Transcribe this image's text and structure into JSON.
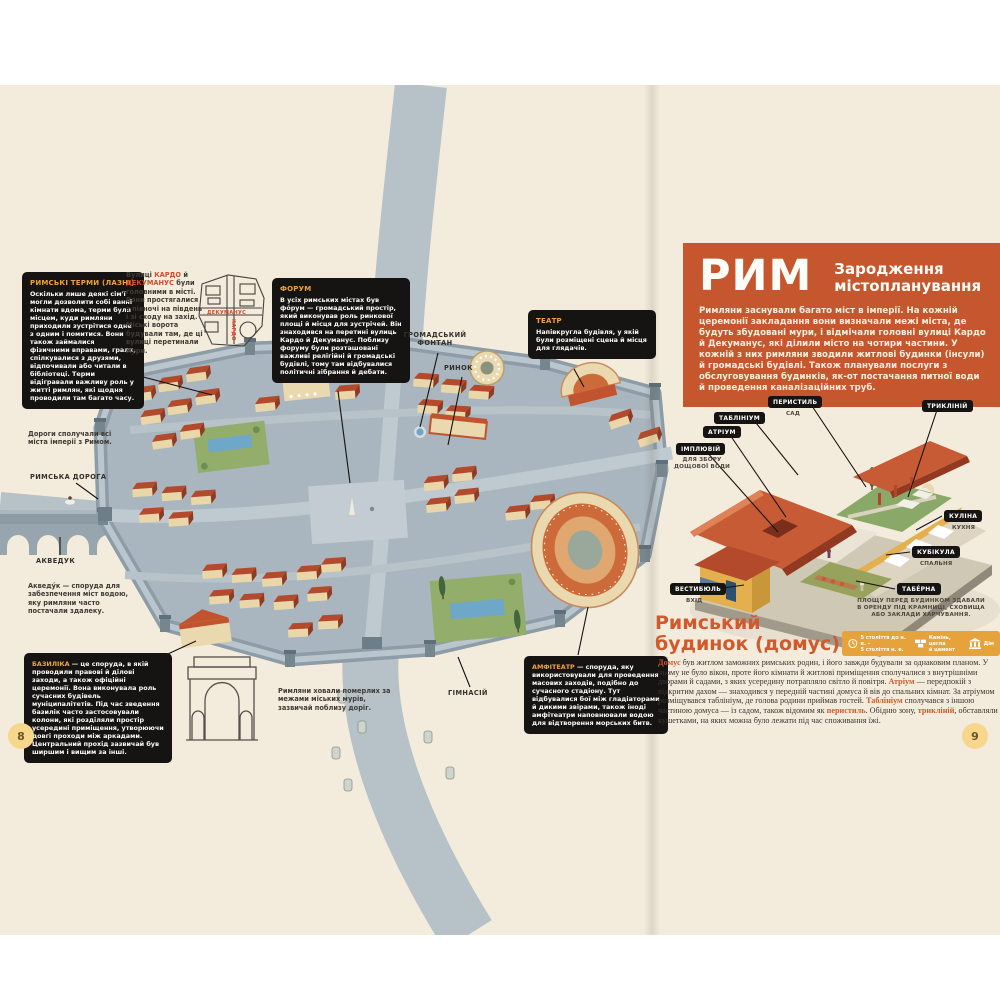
{
  "colors": {
    "accent_orange": "#c5562d",
    "highlight_red": "#d44b28",
    "box_heading_gold": "#f0a23a",
    "legend_bar": "#e7a33b",
    "paper": "#f3ecdd"
  },
  "left_page": {
    "page_number": "8",
    "thermae_box": {
      "title": "РИМСЬКІ ТЕРМИ (ЛАЗНІ)",
      "body": "Оскільки лише деякі сім'ї могли дозволити собі ванні кімнати вдома, терми були місцем, куди римляни приходили зустрітися одне з одним і помитися. Вони також займалися фізичними вправами, грали, спілкувалися з друзями, відпочивали або читали в бібліотеці. Терми відігравали важливу роль у житті римлян, які щодня проводили там багато часу."
    },
    "cardo_note_segments": [
      {
        "t": "Вулиці "
      },
      {
        "t": "КАРДО",
        "c": "c-red"
      },
      {
        "t": " й "
      },
      {
        "t": "ДЕКУМАНУС",
        "c": "c-red"
      },
      {
        "t": " були головними в місті. Вони простягалися з півночі на південь і зі сходу на захід. Міські ворота будували там, де ці вулиці перетинали мури."
      }
    ],
    "minimap": {
      "decumanus": "ДЕКУМАНУС",
      "cardo": "КАРДО"
    },
    "forum_box": {
      "title": "ФОРУМ",
      "body": "В усіх римських містах був фо́рум — громадський простір, який виконував роль ринкової площі й місця для зустрічей. Він знаходився на перетині вулиць Кардо й Декуманус. Поблизу форуму були розташовані важливі релігійні й громадські будівлі, тому там відбувалися політичні зібрання й дебати."
    },
    "theatre_box": {
      "title": "ТЕАТР",
      "body": "Напівкругла будівля, у якій були розміщені сцена й місця для глядачів."
    },
    "basilica_segments": [
      {
        "t": "БАЗИЛІКА",
        "c": "c-gold"
      },
      {
        "t": " — це споруда, в якій проводили правові й ділові заходи, а також офіційні церемонії. Вона виконувала роль сучасних будівель муніципалітетів. Під час зведення базилік часто застосовували колони, які розділяли простір усередині приміщення, утворюючи довгі проходи між аркадами. Центральний прохід зазвичай був ширшим і вищим за інші."
      }
    ],
    "amphitheatre_segments": [
      {
        "t": "АМФІТЕАТР",
        "c": "c-gold"
      },
      {
        "t": " — споруда, яку використовували для проведення масових заходів, подібно до сучасного стадіону. Тут відбувалися бої між гладіаторами й дикими звірами, також іноді амфітеатри наповнювали водою для відтворення морських битв."
      }
    ],
    "roads_note": "Дороги сполучали всі міста імперії з Римом.",
    "roman_road_label": "РИМСЬКА ДОРОГА",
    "aqueduct_label": "АКВЕДУК",
    "aqueduct_note": "Акведу́к — споруда для забезпечення міст водою, яку римляни часто постачали здалеку.",
    "burial_note": "Римляни ховали померлих за межами міських мурів, зазвичай поблизу доріг.",
    "fountain_label": "ГРОМАДСЬКИЙ\nФОНТАН",
    "market_label": "РИНОК",
    "gymnasium_label": "ГІМНАСІЙ"
  },
  "right_page": {
    "page_number": "9",
    "title": "РИМ",
    "subtitle": "Зародження\nмістопланування",
    "intro": "Римляни заснували багато міст в імперії. На кожній церемонії закладання вони визначали межі міста, де будуть збудовані мури, і відмічали головні вулиці Кардо й Декуманус, які ділили місто на чотири частини. У кожній з них римляни зводили житлові будинки (інсули) й громадські будівлі. Також планували послуги з обслуговування будинків, як-от постачання питної води й проведення каналізаційних труб.",
    "domus_section_title": "Римський\nбудинок (домус)",
    "legend": {
      "period": "5 століття до н. е. –\n5 століття н. е.",
      "materials": "Камінь, цегла\nй цемент",
      "type": "Дім"
    },
    "domus_labels": {
      "tablinium": "ТАБЛІНІУМ",
      "peristyle": "ПЕРИСТИЛЬ",
      "peristyle_sub": "САД",
      "triclinium": "ТРИКЛІНІЙ",
      "atrium": "АТРІУМ",
      "impluvium": "ІМПЛЮВІЙ",
      "impluvium_sub": "ДЛЯ ЗБОРУ\nДОЩОВОЇ ВОДИ",
      "culina": "КУЛІНА",
      "culina_sub": "КУХНЯ",
      "cubicula": "КУБІКУЛА",
      "cubicula_sub": "СПАЛЬНЯ",
      "vestibule": "ВЕСТИБЮЛЬ",
      "vestibule_sub": "ВХІД",
      "taberna": "ТАБЕ́РНА",
      "taberna_sub": "ПЛОЩУ ПЕРЕД БУДИНКОМ ЗДАВАЛИ\nВ ОРЕНДУ ПІД КРАМНИЦІ, СХОВИЩА\nАБО ЗАКЛАДИ ХАРЧУВАННЯ."
    },
    "domus_paragraph_segments": [
      {
        "t": "До́мус",
        "c": "c-orange"
      },
      {
        "t": " був житлом заможних римських родин, і його завжди будували за однаковим планом. У ньому не було вікон, проте його кімнати й житлові приміщення сполучалися з внутрішніми дворами й садами, з яких усередину потрапляло світло й повітря. "
      },
      {
        "t": "Атріум",
        "c": "c-orange"
      },
      {
        "t": " — передпокій з відкритим дахом — знаходився у передній частині домуса й вів до спальних кімнат. За атріумом розміщувався таблініум, де голова родини приймав гостей. "
      },
      {
        "t": "Таблініум",
        "c": "c-orange"
      },
      {
        "t": " сполучався з іншою частиною домуса — із садом, також відомим як "
      },
      {
        "t": "перистиль",
        "c": "c-orange"
      },
      {
        "t": ". Обідню зону, "
      },
      {
        "t": "трикліній",
        "c": "c-orange"
      },
      {
        "t": ", обставляли кушетками, на яких можна було лежати під час споживання їжі."
      }
    ]
  }
}
